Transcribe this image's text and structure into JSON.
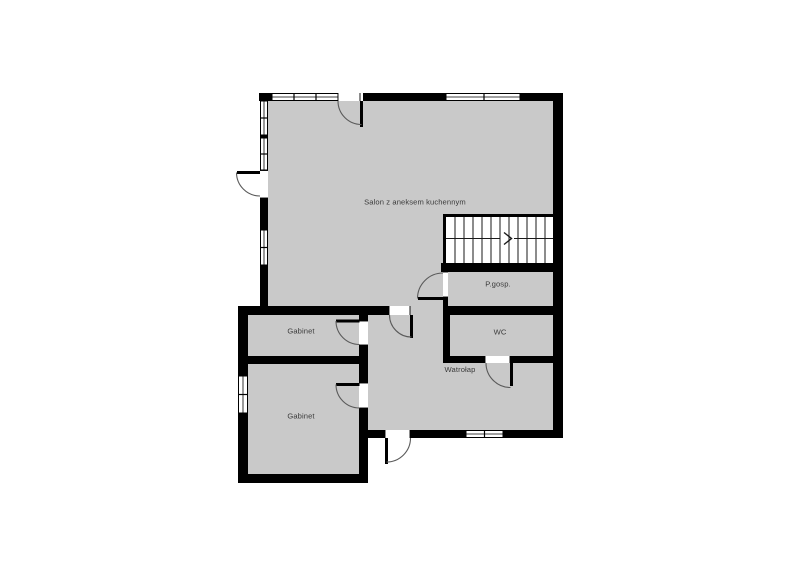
{
  "floorplan": {
    "rooms": {
      "salon": {
        "label": "Salon z aneksem kuchennym"
      },
      "pgosp": {
        "label": "P.gosp."
      },
      "wc": {
        "label": "WC"
      },
      "wiatrolap": {
        "label": "Watrołap"
      },
      "gabinet1": {
        "label": "Gabinet"
      },
      "gabinet2": {
        "label": "Gabinet"
      }
    },
    "stairs": {
      "direction_icon": "chevron-right"
    },
    "colors": {
      "background": "#ffffff",
      "floor_fill": "#c9c9c9",
      "wall": "#000000",
      "opening": "#ffffff",
      "door_arc": "#5a5a5a",
      "label_text": "#3b3b3b"
    }
  }
}
